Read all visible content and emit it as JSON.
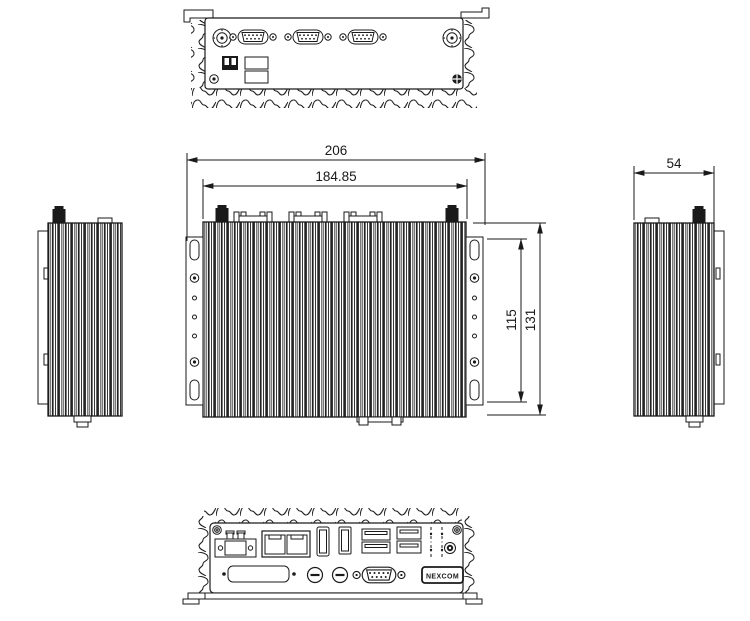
{
  "dimensions": {
    "overall_width": "206",
    "inner_width": "184.85",
    "depth": "54",
    "mount_holes_height": "115",
    "overall_height": "131"
  },
  "logo_text": "NEXCOM",
  "colors": {
    "line": "#1a1a1a",
    "background": "#ffffff"
  }
}
